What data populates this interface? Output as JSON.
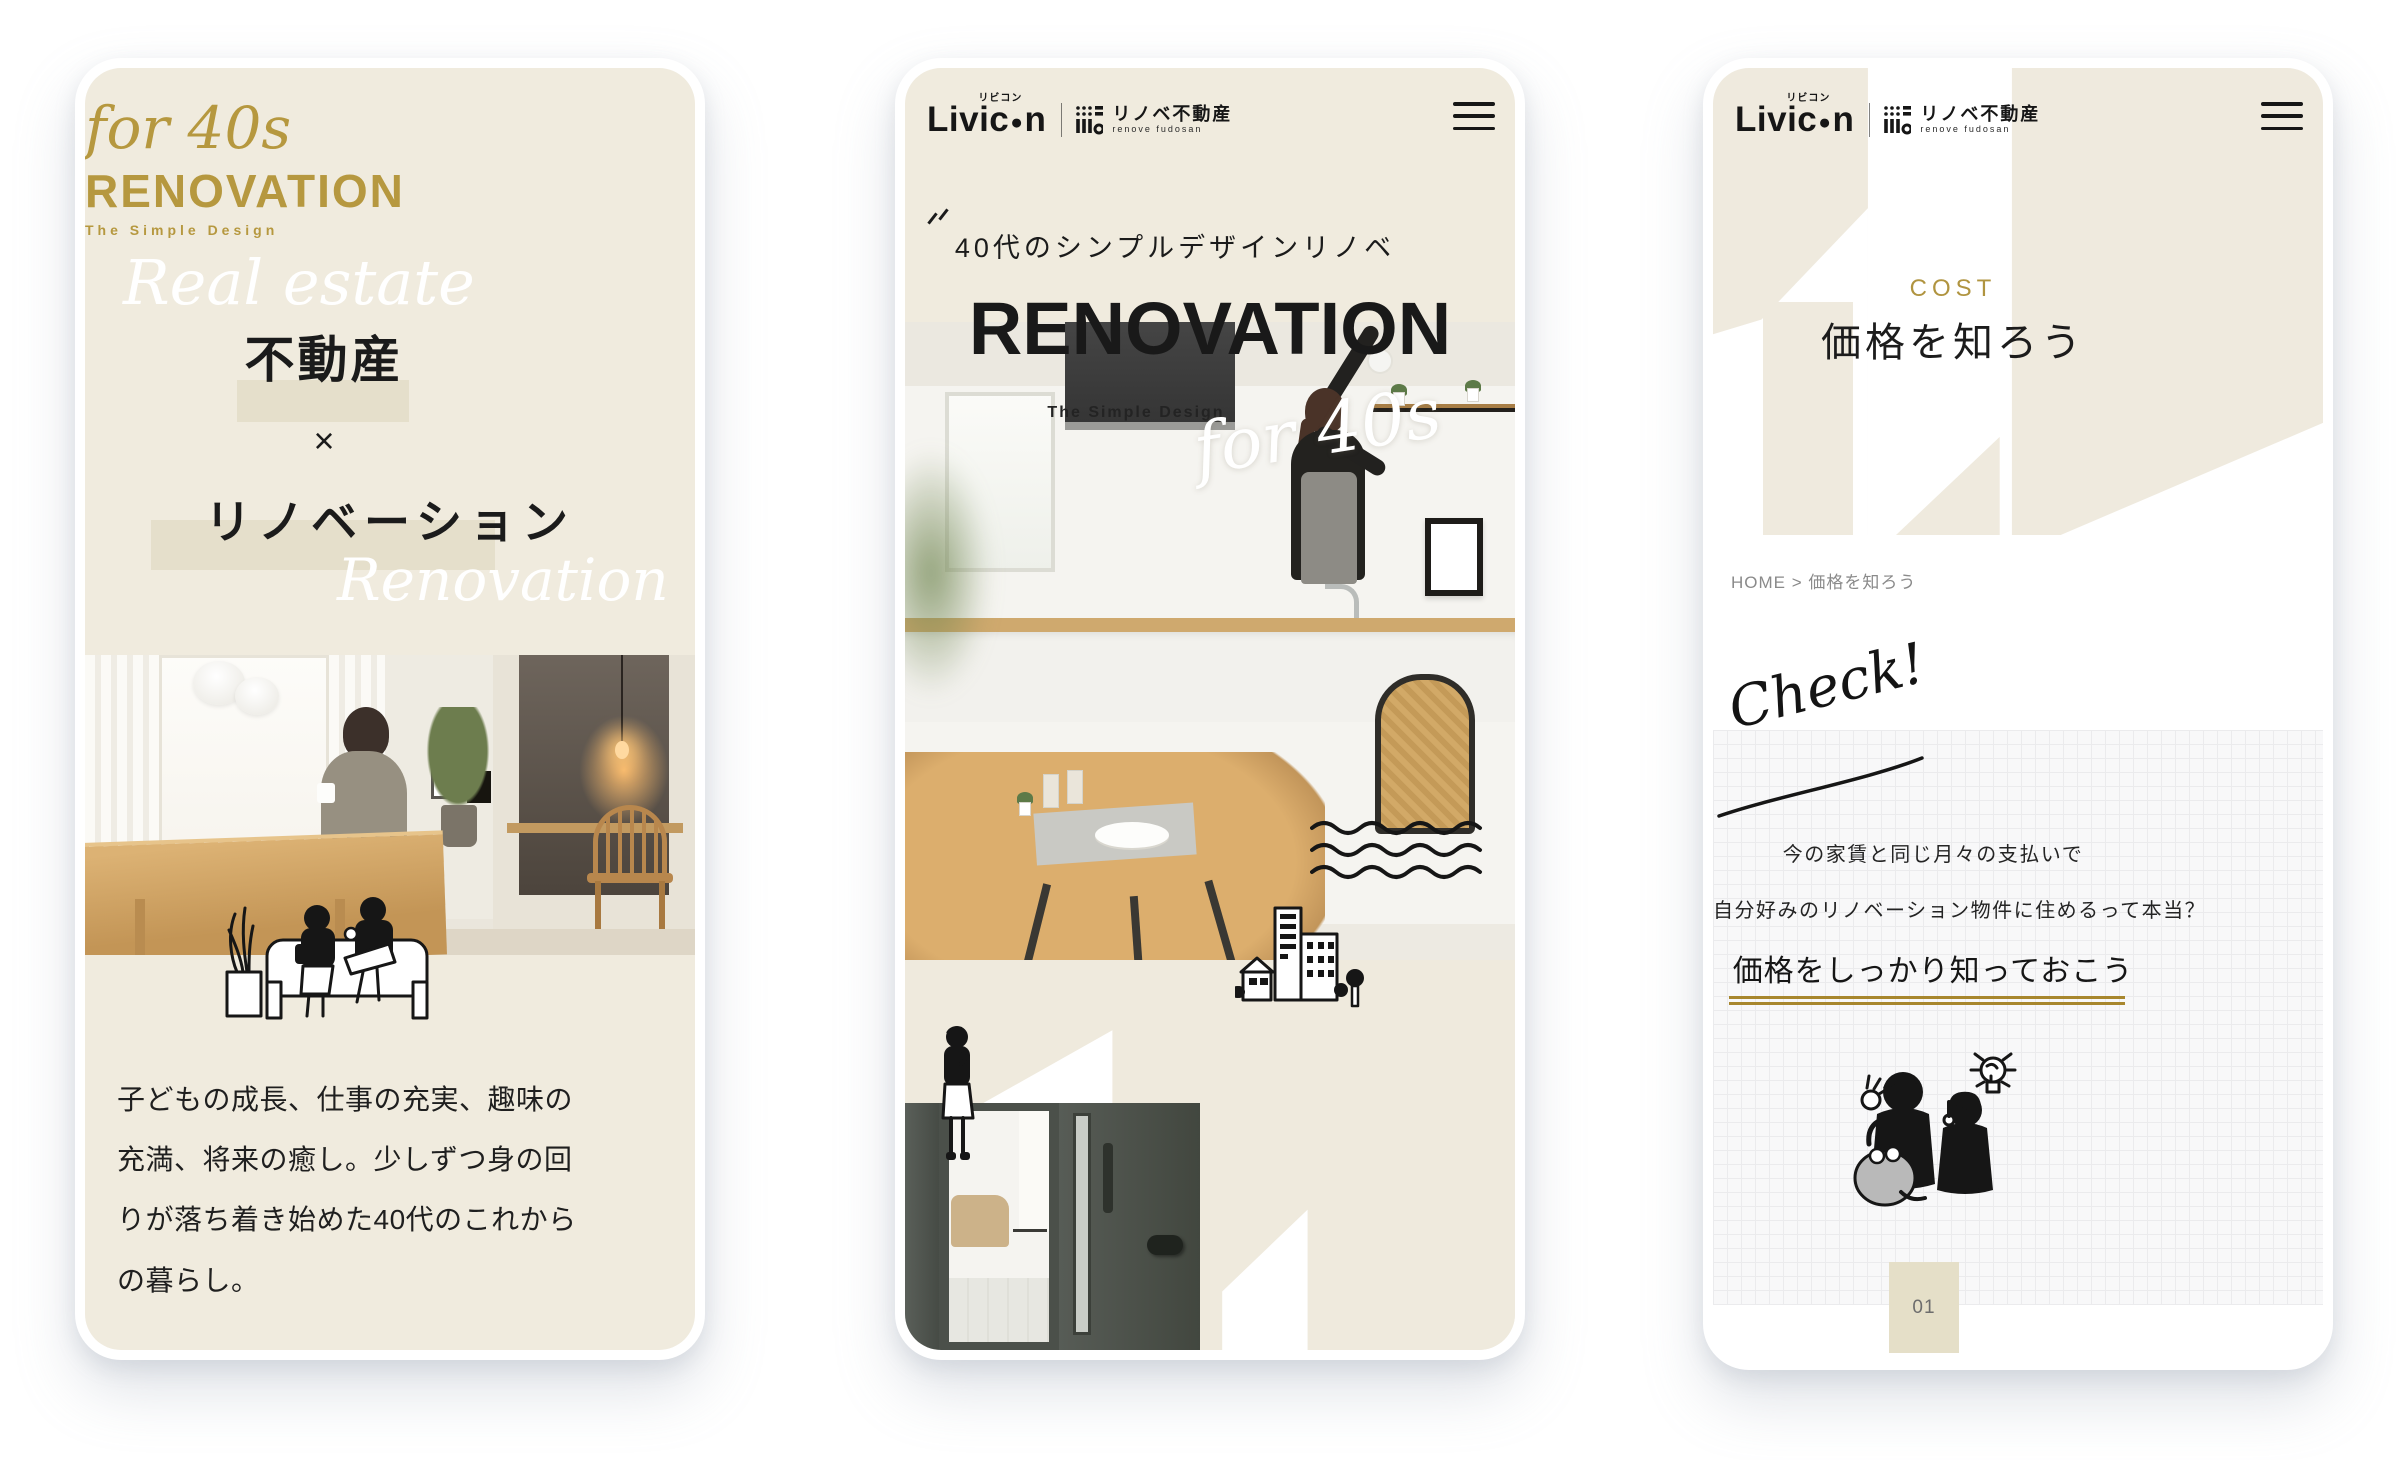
{
  "phones": {
    "p1": {
      "script_top": "for 40s",
      "title": "RENOVATION",
      "subtitle": "The Simple Design",
      "script_left": "Real estate",
      "keyword_top": "不動産",
      "cross": "×",
      "keyword_bottom": "リノベーション",
      "script_right": "Renovation",
      "paragraph": "子どもの成長、仕事の充実、趣味の充満、将来の癒し。少しずつ身の回りが落ち着き始めた40代のこれからの暮らし。"
    },
    "p2": {
      "brand_start": "Livic",
      "brand_dot": "●",
      "brand_end": "n",
      "brand_ruby": "リビコン",
      "partner_name": "リノベ不動産",
      "partner_sub": "renove fudosan",
      "tagline": "40代のシンプルデザインリノベ",
      "title": "RENOVATION",
      "subtitle": "The Simple Design",
      "script": "for 40s"
    },
    "p3": {
      "brand_start": "Livic",
      "brand_dot": "●",
      "brand_end": "n",
      "brand_ruby": "リビコン",
      "partner_name": "リノベ不動産",
      "partner_sub": "renove fudosan",
      "eyebrow": "COST",
      "heading": "価格を知ろう",
      "breadcrumb_home": "HOME",
      "breadcrumb_sep": ">",
      "breadcrumb_current": "価格を知ろう",
      "check": "Check!",
      "lead1": "今の家賃と同じ月々の支払いで",
      "lead2": "自分好みのリノベーション物件に住めるって本当？",
      "emphasis": "価格をしっかり知っておこう",
      "page_num": "01"
    }
  },
  "colors": {
    "beige": "#f0ebde",
    "beige_highlight": "#e5dfcb",
    "gold": "#b6983f",
    "gold_line": "#a8872e",
    "ink": "#1b1b1b",
    "gray": "#8a8a8a"
  }
}
